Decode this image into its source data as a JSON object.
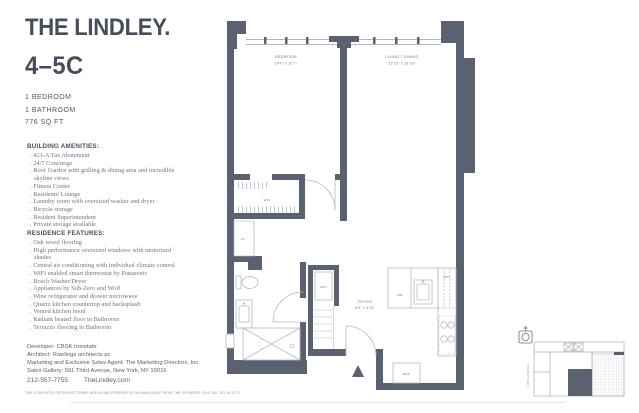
{
  "header": {
    "brand": "THE LINDLEY.",
    "unit": "4–5C",
    "specs": [
      "1 BEDROOM",
      "1 BATHROOM",
      "776 SQ FT"
    ]
  },
  "amenities": {
    "heading": "BUILDING AMENITIES:",
    "items": [
      "421-A Tax Abatement",
      "24/7 Concierge",
      "Roof Garden with grilling & dining area and incredible skyline views",
      "Fitness Center",
      "Residents' Lounge",
      "Laundry room with oversized washer and dryer",
      "Bicycle storage",
      "Resident Superintendent",
      "Private storage available"
    ]
  },
  "features": {
    "heading": "RESIDENCE FEATURES:",
    "items": [
      "Oak wood flooring",
      "High performance oversized windows with motorized shades",
      "Central air conditioning with individual climate control",
      "WiFi enabled smart thermostat by Panasonic",
      "Bosch Washer/Dryer",
      "Appliances by Sub-Zero and Wolf",
      "Wine refrigerator and drawer microwave",
      "Quartz kitchen countertop and backsplash",
      "Vented kitchen hood",
      "Radiant heated floor in Bathroom",
      "Terrazzo flooring in Bathroom"
    ]
  },
  "contact": {
    "developer": "Developer: CBSK Ironstate",
    "architect": "Architect: Rawlings architects pc",
    "agent": "Marketing and Exclusive Sales Agent: The Marketing Directors, Inc.",
    "gallery": "Sales Gallery: 591 Third Avenue, New York, NY 10016",
    "phone": "212-557-7755",
    "website": "TheLindley.com"
  },
  "legal": "THE COMPLETE OFFERING TERMS ARE IN AN OFFERING PLAN AVAILABLE FROM THE SPONSOR. FILE NO. CD 16-0171.",
  "floorplan": {
    "bedroom": {
      "name": "BEDROOM",
      "dims": "14'0\" x 10'7\""
    },
    "living": {
      "name": "LIVING / DINING",
      "dims": "22'10\" x 16'10\""
    },
    "foyer": {
      "name": "FOYER",
      "dims": "8'9\" x 4'10\""
    },
    "wic": "WIC",
    "cl": "CL",
    "wd": "W/D",
    "dw": "DW",
    "mw": "MW",
    "ref": "REF"
  },
  "keyplan": {
    "street": "3RD AVENUE"
  },
  "colors": {
    "wall": "#5a6170",
    "ink": "#454e5c",
    "fixture": "#b4bac4"
  }
}
